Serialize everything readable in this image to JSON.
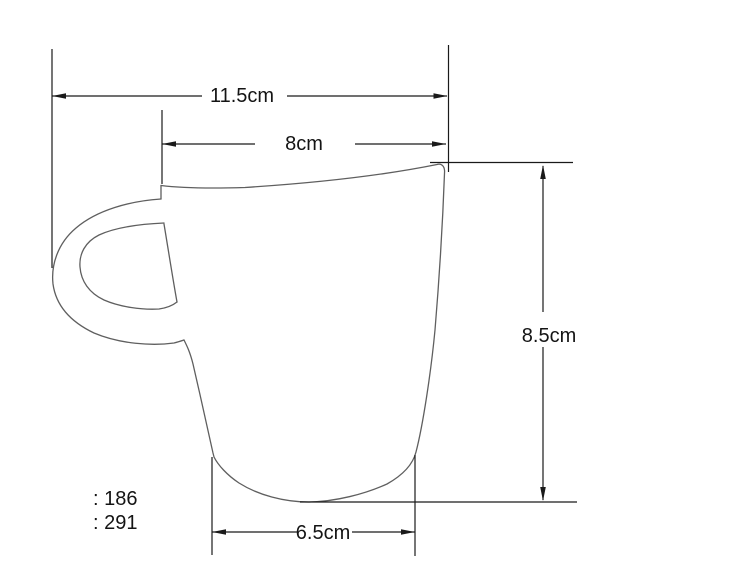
{
  "colors": {
    "background": "#ffffff",
    "dimension_line": "#1a1a1a",
    "cup_outline": "#5f5f5f",
    "text": "#141414"
  },
  "dimensions": {
    "total_width": {
      "label": "11.5cm"
    },
    "rim_width": {
      "label": "8cm"
    },
    "height": {
      "label": "8.5cm"
    },
    "base_width": {
      "label": "6.5cm"
    }
  },
  "notes": [
    {
      "text": ": 186"
    },
    {
      "text": ": 291"
    }
  ]
}
